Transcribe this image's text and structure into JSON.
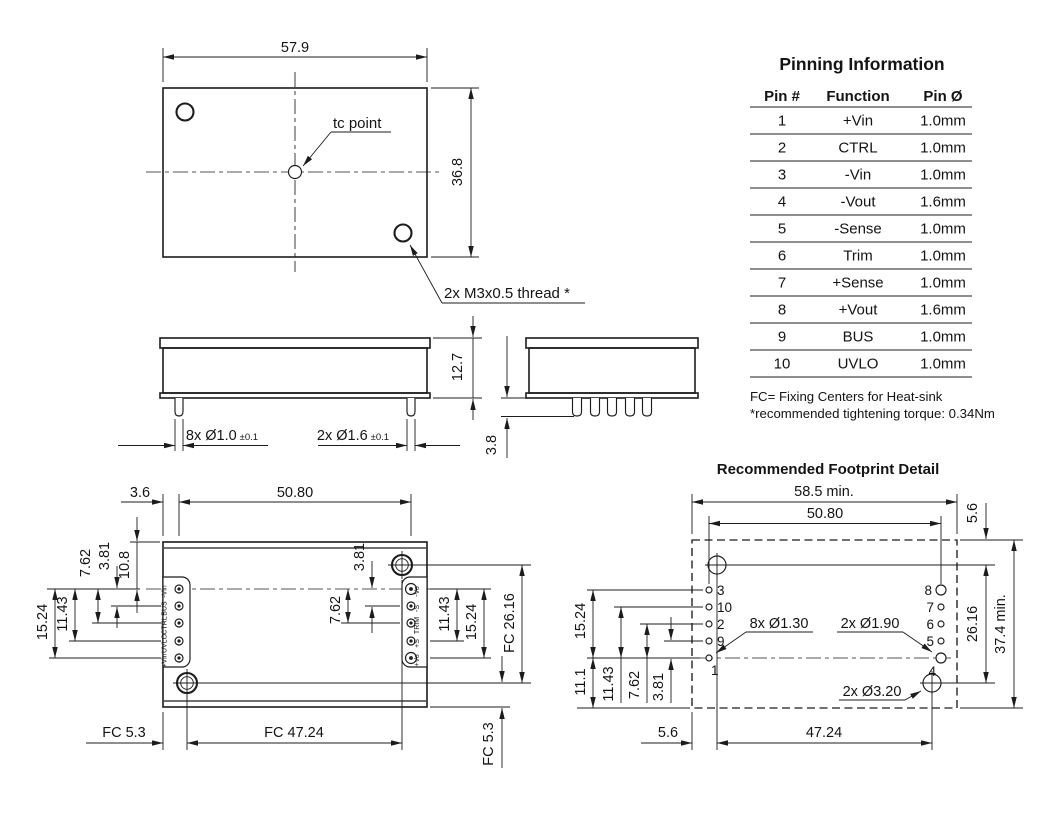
{
  "pinning_table": {
    "title": "Pinning Information",
    "headers": [
      "Pin #",
      "Function",
      "Pin Ø"
    ],
    "rows": [
      [
        "1",
        "+Vin",
        "1.0mm"
      ],
      [
        "2",
        "CTRL",
        "1.0mm"
      ],
      [
        "3",
        "-Vin",
        "1.0mm"
      ],
      [
        "4",
        "-Vout",
        "1.6mm"
      ],
      [
        "5",
        "-Sense",
        "1.0mm"
      ],
      [
        "6",
        "Trim",
        "1.0mm"
      ],
      [
        "7",
        "+Sense",
        "1.0mm"
      ],
      [
        "8",
        "+Vout",
        "1.6mm"
      ],
      [
        "9",
        "BUS",
        "1.0mm"
      ],
      [
        "10",
        "UVLO",
        "1.0mm"
      ]
    ],
    "note_fc": "FC= Fixing Centers for Heat-sink",
    "note_torque": "*recommended tightening torque: 0.34Nm"
  },
  "top_view": {
    "dim_width": "57.9",
    "dim_height": "36.8",
    "tc_label": "tc point",
    "thread_label": "2x M3x0.5 thread *"
  },
  "front_view": {
    "dim_height": "12.7",
    "dim_small_pins": "8x Ø1.0",
    "dim_small_tol": "±0.1",
    "dim_large_pins": "2x Ø1.6",
    "dim_large_tol": "±0.1"
  },
  "end_view": {
    "dim_pin_length": "3.8"
  },
  "bottom_view": {
    "dim_edge_to_pins": "3.6",
    "dim_pin_span": "50.80",
    "dim_left_7_62": "7.62",
    "dim_left_3_81": "3.81",
    "dim_left_10_8": "10.8",
    "dim_left_15_24": "15.24",
    "dim_left_11_43": "11.43",
    "dim_mid_3_81": "3.81",
    "dim_mid_7_62": "7.62",
    "dim_right_11_43": "11.43",
    "dim_right_15_24": "15.24",
    "dim_fc_vertical": "FC 26.16",
    "dim_fc_corner_v": "FC 5.3",
    "dim_fc_corner_h": "FC 5.3",
    "dim_fc_span": "FC 47.24",
    "left_pins": [
      "-Vin",
      "BUS",
      "CTRL",
      "UVLO",
      "+Vin"
    ],
    "right_pins": [
      "-Vo",
      "-S",
      "TRIM",
      "+S",
      "+Vo"
    ]
  },
  "footprint": {
    "title": "Recommended Footprint Detail",
    "dim_width_min": "58.5 min.",
    "dim_pin_span": "50.80",
    "dim_corner_top": "5.6",
    "dim_fc_vertical": "26.16",
    "dim_height_min": "37.4 min.",
    "dim_left_15_24": "15.24",
    "dim_left_11_1": "11.1",
    "dim_left_11_43": "11.43",
    "dim_left_7_62": "7.62",
    "dim_left_3_81": "3.81",
    "dim_corner_bottom": "5.6",
    "dim_fc_span": "47.24",
    "label_pin_holes": "8x Ø1.30",
    "label_power_holes": "2x Ø1.90",
    "label_screw_holes": "2x Ø3.20",
    "left_pin_numbers": [
      "3",
      "10",
      "2",
      "9",
      "1"
    ],
    "right_pin_numbers": [
      "8",
      "7",
      "6",
      "5",
      "4"
    ]
  }
}
